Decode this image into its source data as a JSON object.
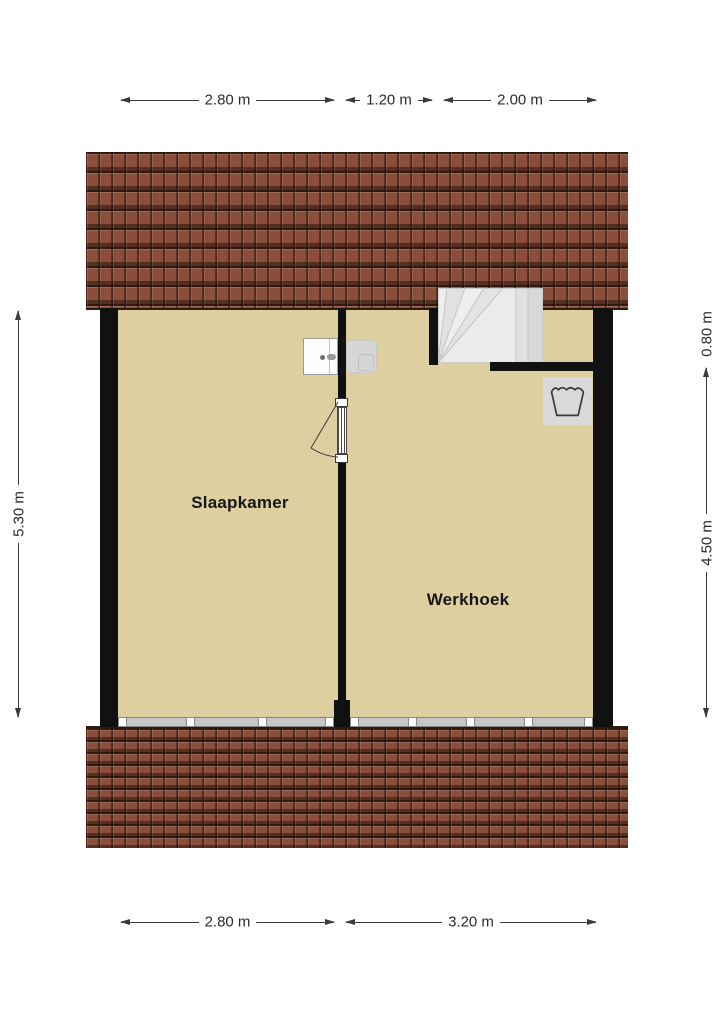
{
  "rooms": [
    {
      "label": "Slaapkamer"
    },
    {
      "label": "Werkhoek"
    }
  ],
  "dimensions": {
    "top": [
      {
        "label": "2.80 m"
      },
      {
        "label": "1.20 m"
      },
      {
        "label": "2.00 m"
      }
    ],
    "bottom": [
      {
        "label": "2.80 m"
      },
      {
        "label": "3.20 m"
      }
    ],
    "left": [
      {
        "label": "5.30 m"
      }
    ],
    "right": [
      {
        "label": "0.80 m"
      },
      {
        "label": "4.50 m"
      }
    ]
  },
  "fixtures": {
    "stairs": "winder-staircase",
    "washbasin": "washbasin-with-tap",
    "cabinet": "gray-fixture",
    "laundry": "laundry-wash-symbol",
    "door": "hinged-door-with-swing-arc",
    "windows": "window-band-with-mullions"
  },
  "colors": {
    "floor": "#ddcfa0",
    "roof": "#8a4e3b",
    "roof_line": "#30190f",
    "wall": "#111111",
    "stair_fill": "#e8e8e8",
    "fixture_gray": "#d6d6d6",
    "dimension_text": "#2b2b2b"
  }
}
